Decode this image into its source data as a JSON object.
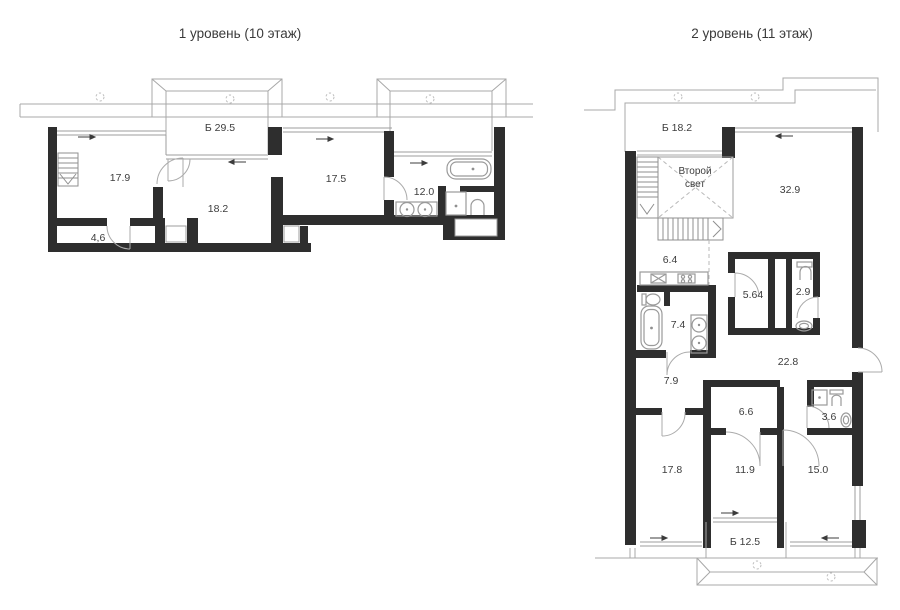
{
  "page": {
    "background": "#ffffff",
    "wall_color": "#2e2e2e",
    "line_color": "#a8a8a8",
    "label_color": "#3d3d3d",
    "drawing_type": "floor-plan"
  },
  "level1": {
    "title": "1 уровень (10 этаж)",
    "balcony_label": "Б 29.5",
    "rooms": {
      "r179": "17.9",
      "r182": "18.2",
      "r46": "4,6",
      "r175": "17.5",
      "r120": "12.0"
    },
    "icons": [
      "staircase-icon",
      "bathtub-icon",
      "double-sink-icon",
      "shower-icon",
      "toilet-icon",
      "bay-window-icon",
      "ventilation-shaft-icon"
    ]
  },
  "level2": {
    "title": "2 уровень (11 этаж)",
    "balcony_top_label": "Б 18.2",
    "balcony_bottom_label": "Б 12.5",
    "void_line1": "Второй",
    "void_line2": "свет",
    "rooms": {
      "r329": "32.9",
      "r64": "6.4",
      "r564": "5.64",
      "r29": "2.9",
      "r74": "7.4",
      "r228": "22.8",
      "r79": "7.9",
      "r66": "6.6",
      "r36": "3.6",
      "r178": "17.8",
      "r119": "11.9",
      "r150": "15.0"
    },
    "icons": [
      "staircase-icon",
      "kitchen-sink-icon",
      "stove-icon",
      "bathtub-icon",
      "double-sink-icon",
      "toilet-icon",
      "washing-machine-icon",
      "wash-basin-icon",
      "ventilation-shaft-icon"
    ]
  }
}
